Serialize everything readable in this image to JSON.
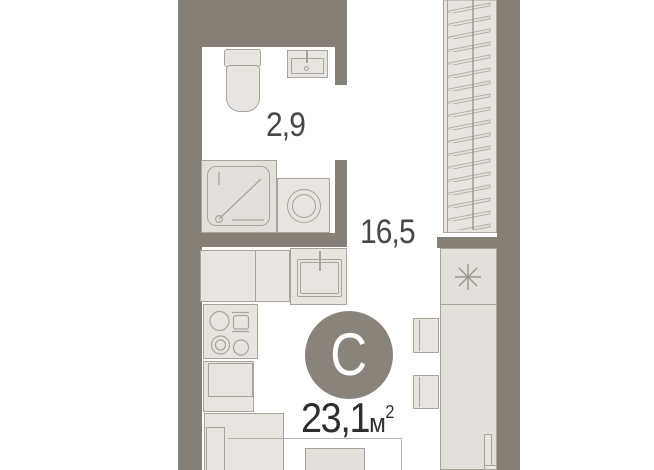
{
  "plan": {
    "type_badge": "С",
    "total_area": {
      "value": "23,1",
      "unit": "м",
      "sup": "2"
    },
    "rooms": [
      {
        "id": "bathroom",
        "area": "2,9"
      },
      {
        "id": "living-kitchen",
        "area": "16,5"
      }
    ]
  },
  "icons": {
    "closet_marker": "asterisk"
  },
  "colors": {
    "wall": "#857f75",
    "furn-fill": "#e8e5e0",
    "furn-fill2": "#e3dfda",
    "furn-border": "#a9a39a",
    "hatch": "#b5afa6",
    "badge": "#8a837a",
    "label": "#474747",
    "bg": "#ffffff"
  }
}
